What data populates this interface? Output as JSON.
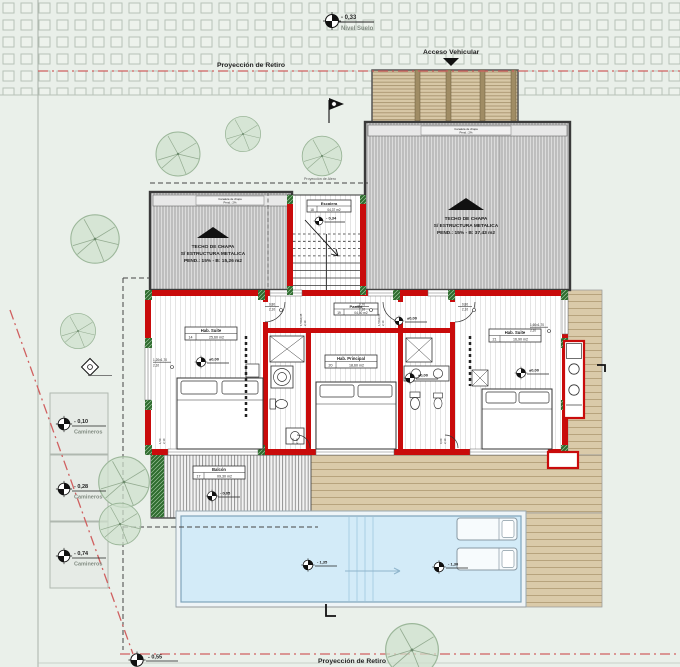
{
  "site": {
    "retiro": "Proyección de Retiro",
    "alero": "Proyección de Alero",
    "acceso": "Acceso Vehicular",
    "nivel": {
      "value": "- 0,33",
      "label": "Nivel Suelo"
    },
    "camineros": [
      {
        "value": "- 0,10",
        "label": "Camineros"
      },
      {
        "value": "- 0,28",
        "label": "Camineros"
      },
      {
        "value": "- 0,74",
        "label": "Camineros"
      }
    ],
    "bottom_level": {
      "value": "- 0,55"
    }
  },
  "roofs": {
    "left": {
      "l1": "TECHO DE CHAPA",
      "l2": "S/ ESTRUCTURA METALICA",
      "l3": "PEND.: 15% - B: 15,26 m2",
      "gutter1": "Canaleta de chapa",
      "gutter2": "Pend.: 2%"
    },
    "right": {
      "l1": "TECHO DE CHAPA",
      "l2": "S/ ESTRUCTURA METALICA",
      "l3": "PEND.: 15% - B: 37,43 m2",
      "gutter1": "Canaleta de chapa",
      "gutter2": "Pend.: 2%"
    }
  },
  "rooms": {
    "suite14": {
      "name": "Hab. Suite",
      "num": "14",
      "area": "25,60 m2",
      "level": "±0,00"
    },
    "principal": {
      "name": "Hab. Principal",
      "num": "20",
      "area": "18,60 m2",
      "level": "±0,00"
    },
    "suite21": {
      "name": "Hab. Suite",
      "num": "21",
      "area": "16,90 m2",
      "level": "±0,00"
    },
    "pasillo": {
      "name": "Pasillo",
      "num": "19",
      "area": "04,50 m2",
      "level": "±0,00"
    },
    "escalera": {
      "name": "Escalera",
      "num": "18",
      "area": "04,37 m2",
      "level": "- 0,34"
    },
    "balcon": {
      "name": "Balcón",
      "num": "17",
      "area": "09,30 m2",
      "level": "- 0,05"
    }
  },
  "pool": {
    "level_left": "- 1,35",
    "level_right": "- 1,30"
  },
  "tags": {
    "door80": {
      "a": "0,80",
      "b": "2,10"
    },
    "door70": {
      "a": "0,70",
      "b": "2,10"
    },
    "door60": {
      "a": "0,60",
      "b": "2,10"
    },
    "win_left": {
      "a": "1,20x1,70",
      "b": "2,10"
    },
    "win_right": {
      "a": "1,60x1,70",
      "b": "2,10"
    },
    "win_high": {
      "a": "1,50x0,45",
      "b": "2,10"
    },
    "slider": {
      "a": "1,50",
      "b": "2,10"
    }
  },
  "colors": {
    "wall": "#c90b0b",
    "retiro": "#d06060",
    "pool": "#d3ebf8",
    "deck": "#d9c9a9",
    "tree": "#cfe0cd",
    "background": "#eaf0ea"
  }
}
